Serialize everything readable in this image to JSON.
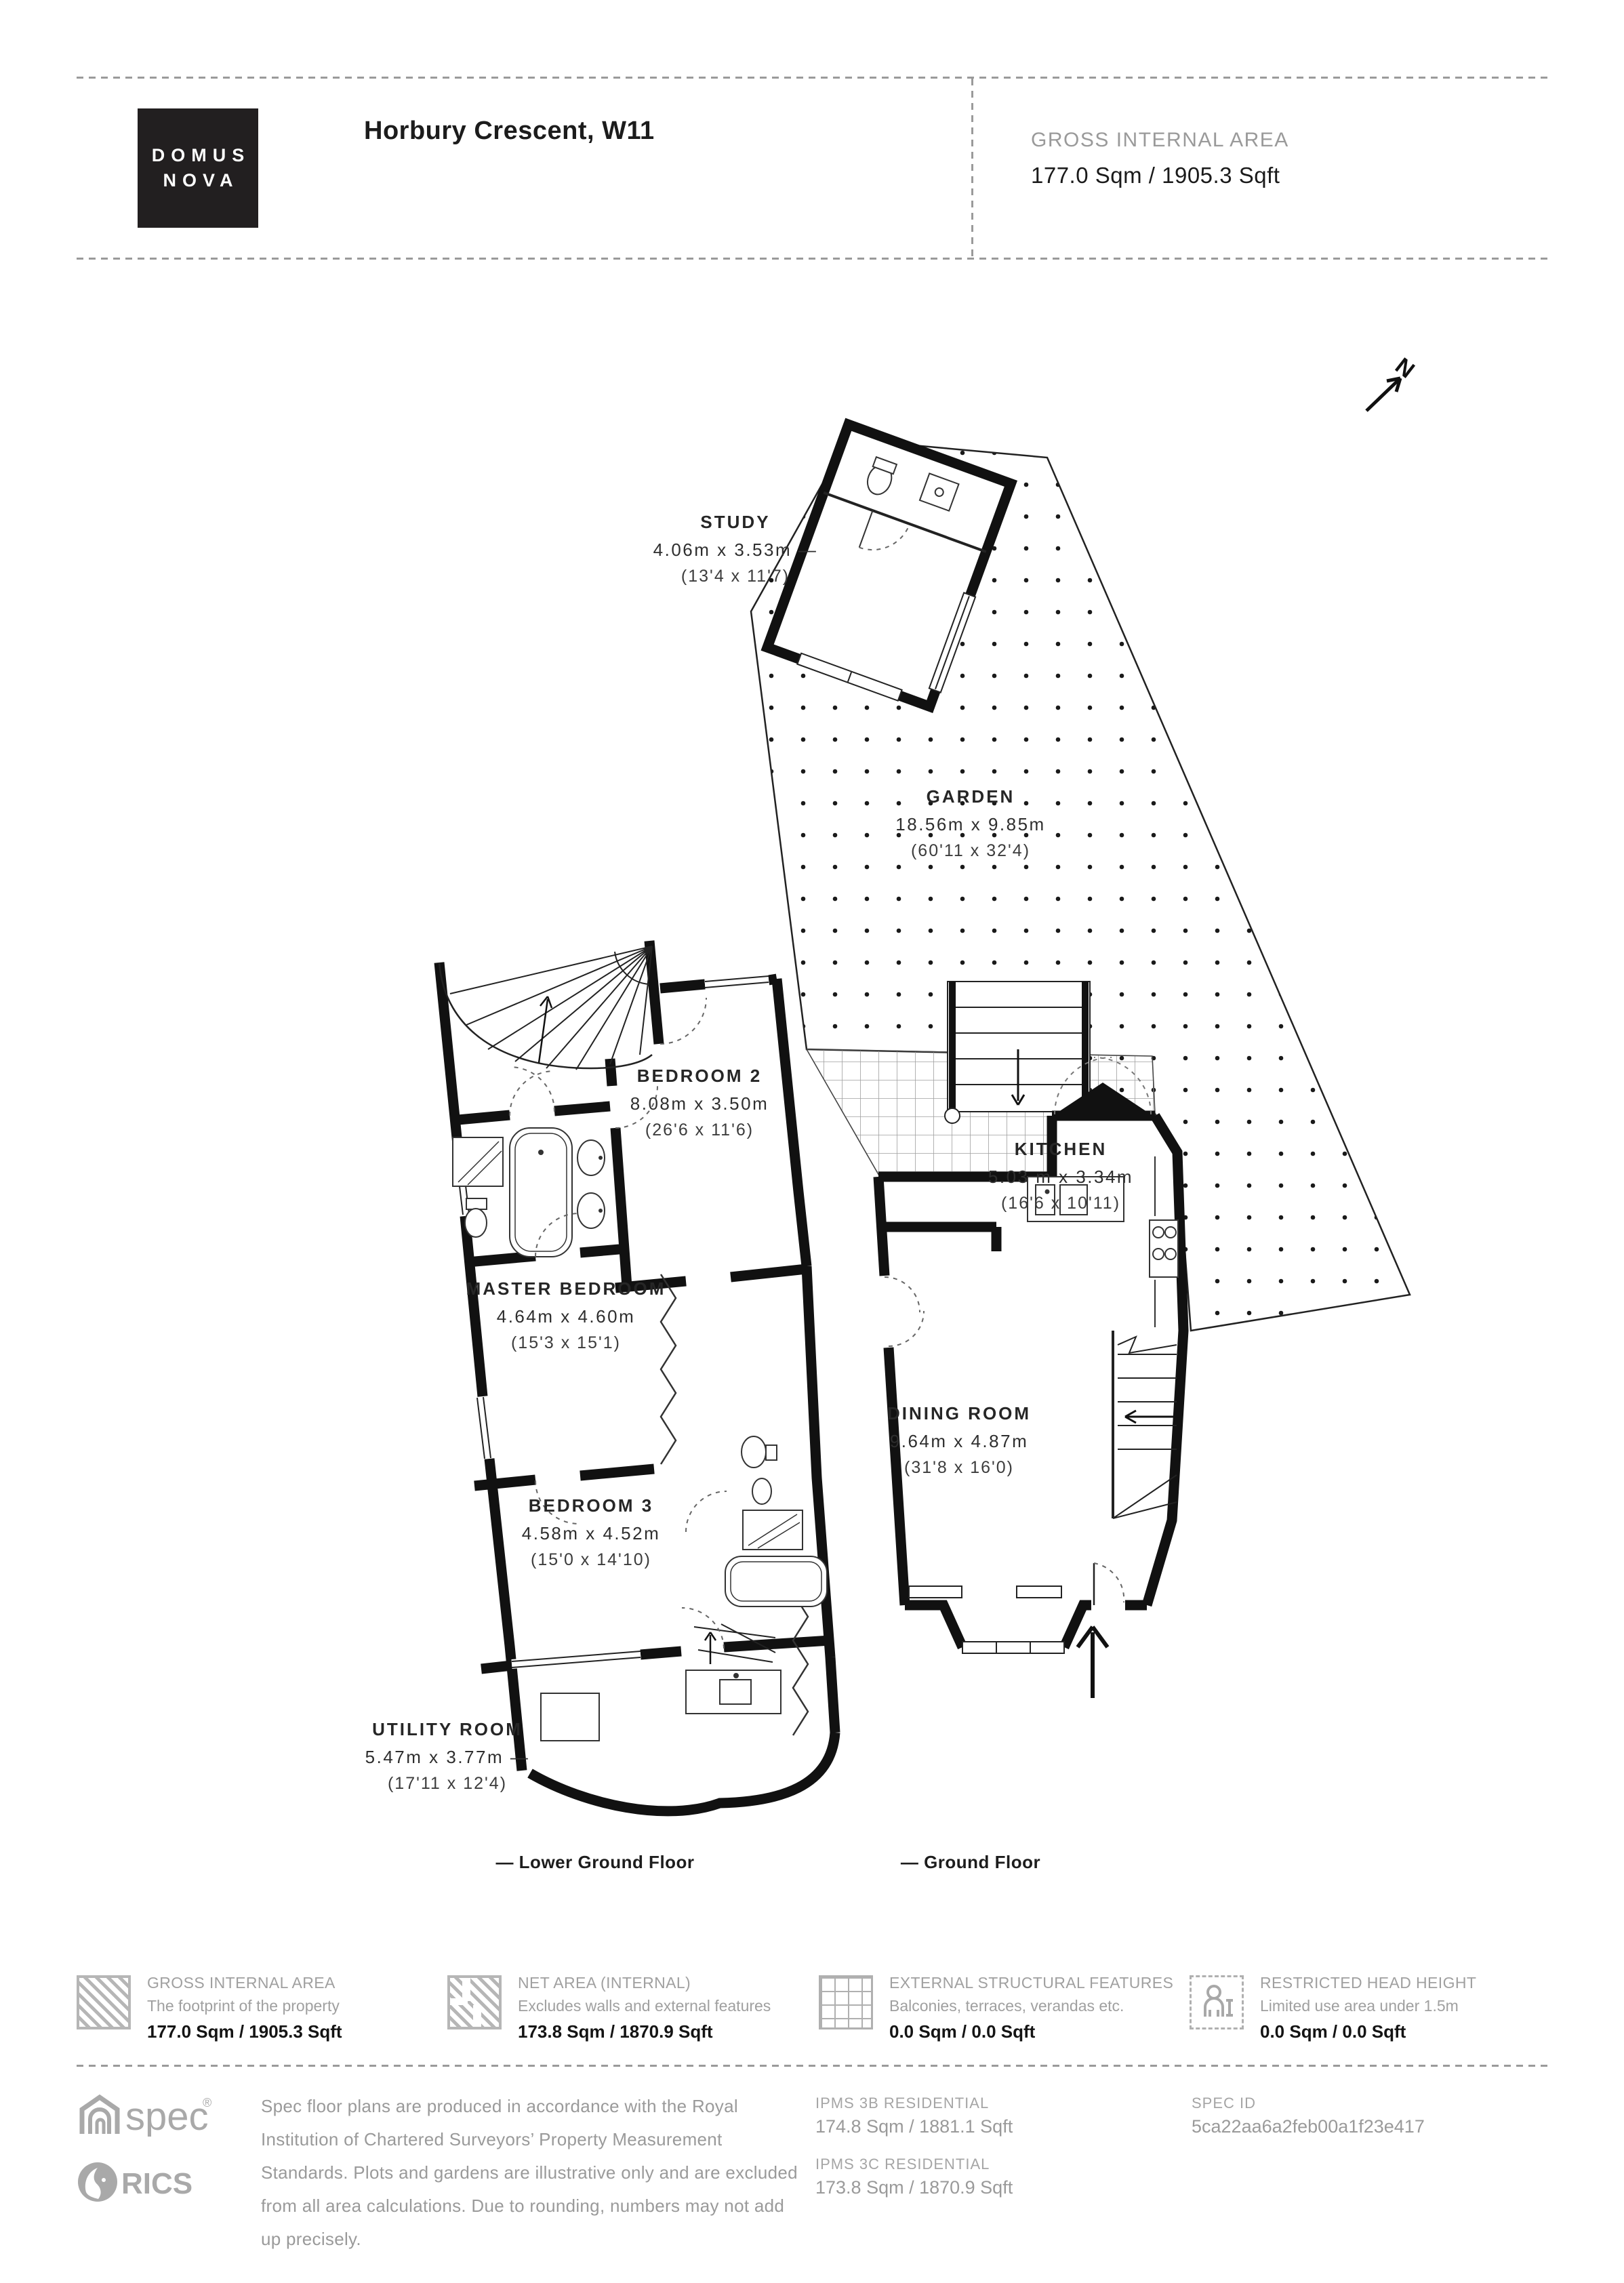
{
  "header": {
    "brand_line1": "DOMUS",
    "brand_line2": "NOVA",
    "title": "Horbury Crescent, W11",
    "gia_label": "GROSS INTERNAL AREA",
    "gia_value": "177.0 Sqm / 1905.3 Sqft"
  },
  "plan": {
    "north_label": "N",
    "rooms": [
      {
        "id": "study",
        "name": "STUDY",
        "dims": "4.06m x 3.53m —",
        "dims_ft": "(13'4 x 11'7)"
      },
      {
        "id": "garden",
        "name": "GARDEN",
        "dims": "18.56m x 9.85m",
        "dims_ft": "(60'11 x 32'4)"
      },
      {
        "id": "kitchen",
        "name": "KITCHEN",
        "dims": "5.03 m x 3.34m",
        "dims_ft": "(16'6 x 10'11)"
      },
      {
        "id": "dining-room",
        "name": "DINING ROOM",
        "dims": "9.64m x 4.87m",
        "dims_ft": "(31'8 x 16'0)"
      },
      {
        "id": "bedroom-2",
        "name": "BEDROOM 2",
        "dims": "8.08m x 3.50m",
        "dims_ft": "(26'6 x 11'6)"
      },
      {
        "id": "master-bedroom",
        "name": "MASTER BEDROOM",
        "dims": "4.64m x 4.60m",
        "dims_ft": "(15'3 x 15'1)"
      },
      {
        "id": "bedroom-3",
        "name": "BEDROOM 3",
        "dims": "4.58m x 4.52m",
        "dims_ft": "(15'0 x 14'10)"
      },
      {
        "id": "utility-room",
        "name": "UTILITY ROOM",
        "dims": "5.47m x 3.77m —",
        "dims_ft": "(17'11 x 12'4)"
      }
    ],
    "floors": [
      {
        "label": "— Lower Ground Floor"
      },
      {
        "label": "— Ground Floor"
      }
    ]
  },
  "legend": {
    "items": [
      {
        "icon": "hatched-square",
        "label": "GROSS INTERNAL AREA",
        "desc": "The footprint of the property",
        "value": "177.0 Sqm / 1905.3 Sqft"
      },
      {
        "icon": "hatched-plan",
        "label": "NET AREA (INTERNAL)",
        "desc": "Excludes walls and external features",
        "value": "173.8 Sqm / 1870.9 Sqft"
      },
      {
        "icon": "grid-square",
        "label": "EXTERNAL STRUCTURAL FEATURES",
        "desc": "Balconies, terraces, verandas etc.",
        "value": "0.0 Sqm / 0.0 Sqft"
      },
      {
        "icon": "person-dashed",
        "label": "RESTRICTED HEAD HEIGHT",
        "desc": "Limited use area under 1.5m",
        "value": "0.0 Sqm / 0.0 Sqft"
      }
    ]
  },
  "footer": {
    "spec_logo": "spec",
    "rics_logo": "RICS",
    "disclaimer_lines": [
      "Spec floor plans are produced in accordance with the Royal",
      "Institution of Chartered Surveyors’ Property Measurement",
      "Standards. Plots and gardens are illustrative only and are excluded",
      "from all area calculations. Due to rounding, numbers may not add",
      "up precisely."
    ],
    "ipms3b_label": "IPMS 3B RESIDENTIAL",
    "ipms3b_value": "174.8 Sqm / 1881.1 Sqft",
    "ipms3c_label": "IPMS 3C RESIDENTIAL",
    "ipms3c_value": "173.8 Sqm / 1870.9 Sqft",
    "specid_label": "SPEC ID",
    "specid_value": "5ca22aa6a2feb00a1f23e417"
  },
  "colors": {
    "wall": "#111111",
    "gray_text": "#9a9a9a",
    "hatch_gray": "#b6b6b6"
  }
}
